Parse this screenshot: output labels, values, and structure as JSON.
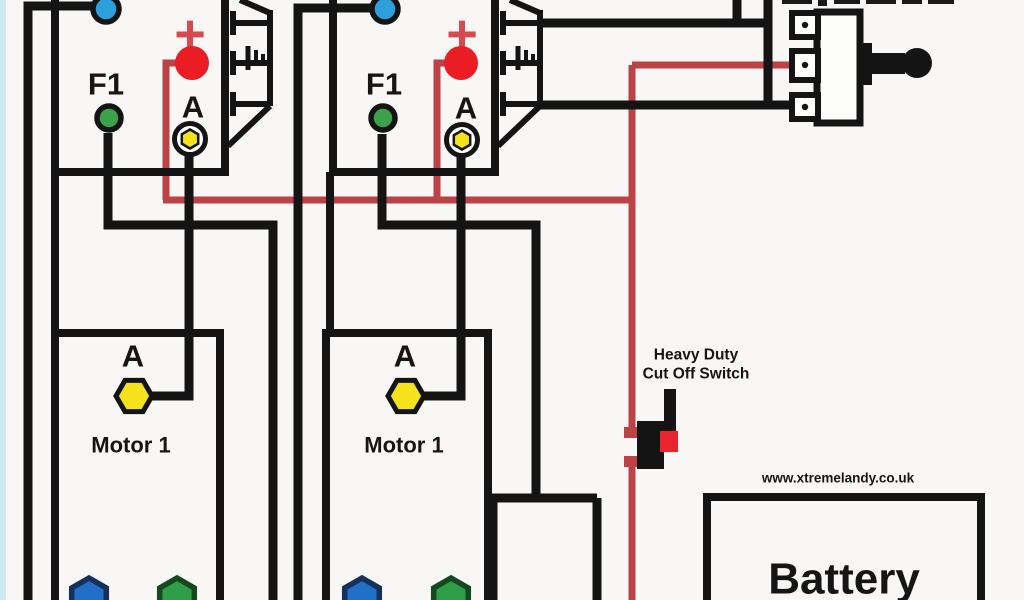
{
  "colors": {
    "background": "#f8f7f5",
    "left_strip": "#cfe9f2",
    "wire_black": "#141414",
    "wire_red": "#bc4246",
    "plus_red": "#d6494e",
    "terminal_red": "#ea1c24",
    "terminal_blue": "#2da0dc",
    "terminal_green": "#3ba14b",
    "terminal_yellow": "#f6e21c",
    "motor_blue": "#2070c8",
    "motor_green": "#2f9e49",
    "switch_red": "#e8252c"
  },
  "solenoids": [
    {
      "plus_label": "+",
      "f1_label": "F1",
      "a_label": "A"
    },
    {
      "plus_label": "+",
      "f1_label": "F1",
      "a_label": "A"
    }
  ],
  "motors": [
    {
      "a_label": "A",
      "name": "Motor 1"
    },
    {
      "a_label": "A",
      "name": "Motor 1"
    }
  ],
  "cutoff_switch": {
    "label_line1": "Heavy Duty",
    "label_line2": "Cut Off Switch"
  },
  "website": {
    "url_text": "www.xtremelandy.co.uk"
  },
  "battery": {
    "label": "Battery"
  }
}
